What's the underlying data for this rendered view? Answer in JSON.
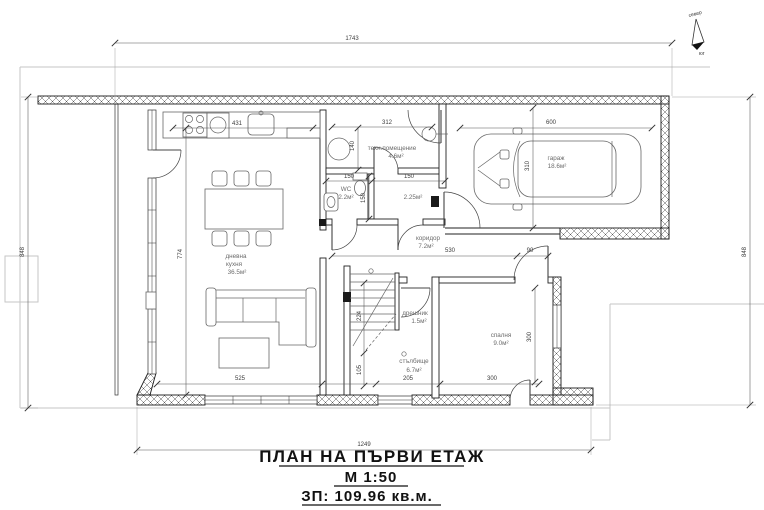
{
  "title_block": {
    "title": "ПЛАН НА ПЪРВИ ЕТАЖ",
    "scale": "М 1:50",
    "area": "ЗП: 109.96 кв.м."
  },
  "compass": {
    "north": "север",
    "south": "юг"
  },
  "rooms": {
    "living": {
      "line1": "дневна",
      "line2": "кухня",
      "area": "36.5м²"
    },
    "tech": {
      "name": "техн.помещение",
      "area": "4.6м²"
    },
    "wc": {
      "name": "WC",
      "area": "2.2м²"
    },
    "storage": {
      "area": "2.25м²"
    },
    "garage": {
      "name": "гараж",
      "area": "18.6м²"
    },
    "corridor": {
      "name": "коридор",
      "area": "7.2м²"
    },
    "wardrobe": {
      "name": "дрешник",
      "area": "1.5м²"
    },
    "stairs": {
      "name": "стълбище",
      "area": "6.7м²"
    },
    "bedroom": {
      "name": "спалня",
      "area": "9.0м²"
    }
  },
  "dimensions": {
    "overall_top": "1743",
    "overall_left": "848",
    "overall_right": "848",
    "overall_bottom": "1249",
    "kitchen_counter": "431",
    "tech_width": "312",
    "tech_height": "140",
    "garage_width": "600",
    "garage_depth": "310",
    "wc_width": "150",
    "storage_width": "150",
    "wc_depth": "150",
    "corridor_length": "530",
    "door_width": "90",
    "living_depth": "774",
    "living_width": "525",
    "stairs_width": "205",
    "bedroom_width": "300",
    "stairs_depth": "224",
    "stairs_lower": "105",
    "bedroom_depth": "300"
  },
  "colors": {
    "wall": "#1a1a1a",
    "boundary": "#c6c6c6",
    "paper": "#ffffff"
  }
}
